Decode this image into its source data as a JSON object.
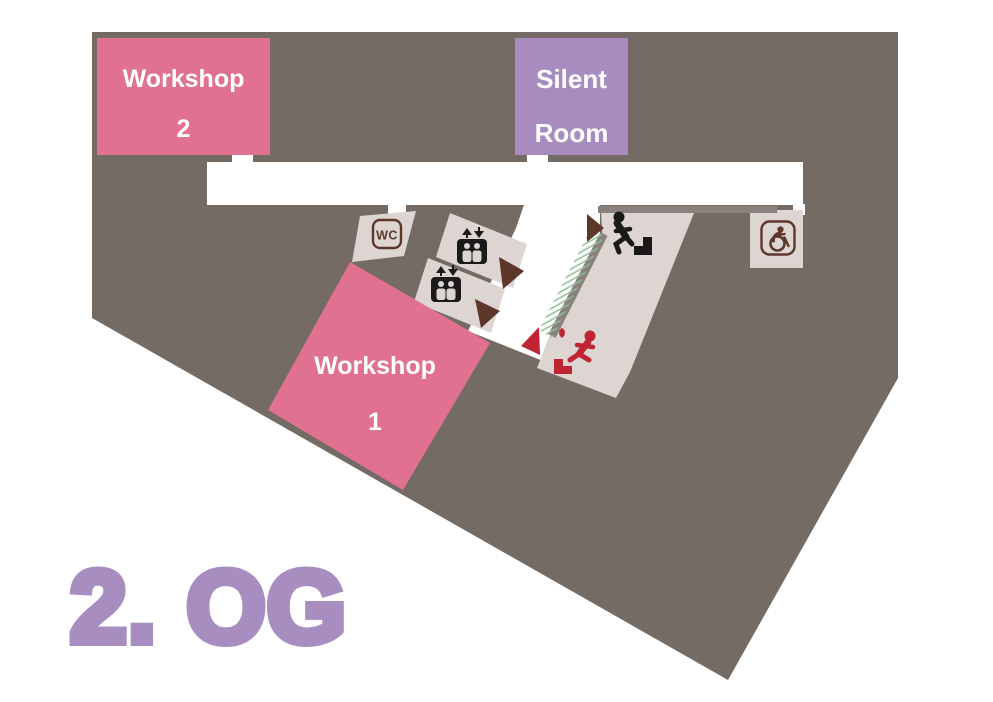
{
  "floor_label": "2. OG",
  "rooms": {
    "workshop2": {
      "line1": "Workshop",
      "line2": "2"
    },
    "silent_room": {
      "line1": "Silent",
      "line2": "Room"
    },
    "workshop1": {
      "line1": "Workshop",
      "line2": "1"
    }
  },
  "icon_labels": {
    "wc": "WC"
  },
  "icons": {
    "wc": "wc-sign in rounded brown frame",
    "elevator": "elevator box with two figures and up/down arrows (two lift rooms)",
    "stairs_up": "person walking up stairs (black)",
    "emergency_exit": "person running down stairs (red emergency exit)",
    "accessible_wc": "wheelchair accessible toilet in rounded brown frame",
    "direction_arrows": "three dark-brown route arrowheads along the hallway",
    "exit_arrow": "red arrowhead pointing to the stairwell exit",
    "green_hatch": "green hatched strip along stairwell wall"
  },
  "colors": {
    "bg": "#746b64",
    "beige": "#dcd5d1",
    "wall": "#8a817c",
    "pink": "#e07190",
    "purple": "#a88cc0",
    "floor-label": "#a78dc0",
    "brown": "#5d372a",
    "red": "#bf2433",
    "green": "#8fbe97",
    "ink": "#1a1a1a",
    "white": "#ffffff"
  }
}
